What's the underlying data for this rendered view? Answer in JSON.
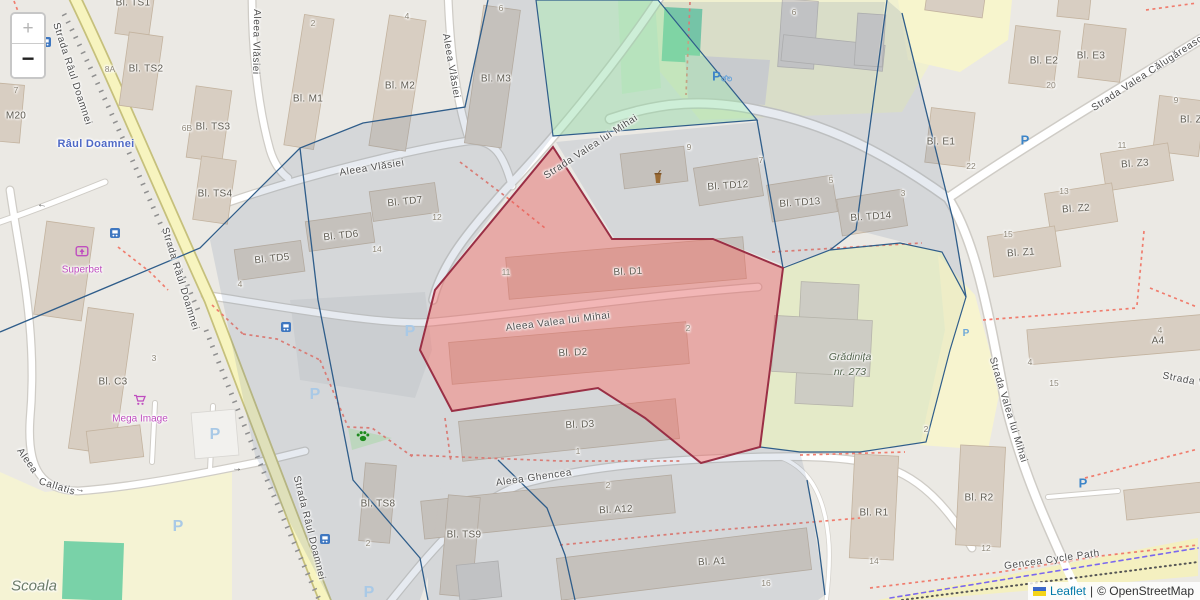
{
  "attribution": {
    "leaflet": "Leaflet",
    "separator": "|",
    "osm": "© OpenStreetMap"
  },
  "controls": {
    "zoom_in": "+",
    "zoom_out": "−"
  },
  "palette": {
    "selected_polygon_fill": "#E05C5C",
    "selected_polygon_stroke": "#9A2F45",
    "district_polygon_stroke": "#2F5D8A",
    "green_polygon_fill": "#8CD7A0",
    "primary_road_yellow": "#F7F4BF",
    "leaflet_link_blue": "#0078A8",
    "poi_magenta": "#BF4EBF",
    "water_label_blue": "#4F69C6"
  },
  "labels": {
    "streets": [
      {
        "t": "Strada Râul Doamnei",
        "x": 72,
        "y": 74,
        "r": 72
      },
      {
        "t": "Strada Râul Doamnei",
        "x": 180,
        "y": 279,
        "r": 73
      },
      {
        "t": "Strada Râul Doamnei",
        "x": 309,
        "y": 528,
        "r": 76
      },
      {
        "t": "Aleea Vlăsiei",
        "x": 256,
        "y": 42,
        "r": 91
      },
      {
        "t": "Aleea Vlăsiei",
        "x": 451,
        "y": 66,
        "r": 80
      },
      {
        "t": "Aleea Vlăsiei",
        "x": 372,
        "y": 168,
        "r": -9
      },
      {
        "t": "Strada Valea lui Mihai",
        "x": 591,
        "y": 147,
        "r": -33
      },
      {
        "t": "Aleea Valea lui Mihai",
        "x": 558,
        "y": 322,
        "r": -7
      },
      {
        "t": "Strada Valea Călugărească",
        "x": 1150,
        "y": 72,
        "r": -33
      },
      {
        "t": "Strada Valea lui Mihai",
        "x": 1008,
        "y": 410,
        "r": 73
      },
      {
        "t": "Strada V",
        "x": 1184,
        "y": 380,
        "r": 11
      },
      {
        "t": "Aleea Ghencea",
        "x": 534,
        "y": 478,
        "r": -8
      },
      {
        "t": "Aleea",
        "x": 27,
        "y": 461,
        "r": 55
      },
      {
        "t": "Callatis",
        "x": 57,
        "y": 487,
        "r": 17
      },
      {
        "t": "Gencea Cycle Path",
        "x": 1052,
        "y": 560,
        "r": -8
      }
    ],
    "buildings": [
      {
        "t": "Bl. TS1",
        "x": 133,
        "y": 3
      },
      {
        "t": "Bl. TS2",
        "x": 146,
        "y": 69
      },
      {
        "t": "Bl. TS3",
        "x": 213,
        "y": 127
      },
      {
        "t": "Bl. TS4",
        "x": 215,
        "y": 194
      },
      {
        "t": "M20",
        "x": 16,
        "y": 116
      },
      {
        "t": "Bl. M1",
        "x": 308,
        "y": 99
      },
      {
        "t": "Bl. M2",
        "x": 400,
        "y": 86
      },
      {
        "t": "Bl. M3",
        "x": 496,
        "y": 79
      },
      {
        "t": "Bl. TD7",
        "x": 405,
        "y": 202,
        "r": -6
      },
      {
        "t": "Bl. TD6",
        "x": 341,
        "y": 236,
        "r": -6
      },
      {
        "t": "Bl. TD5",
        "x": 272,
        "y": 259,
        "r": -6
      },
      {
        "t": "Bl. TD12",
        "x": 728,
        "y": 186,
        "r": -4
      },
      {
        "t": "Bl. TD13",
        "x": 800,
        "y": 203,
        "r": -4
      },
      {
        "t": "Bl. TD14",
        "x": 871,
        "y": 217,
        "r": -4
      },
      {
        "t": "Bl. E1",
        "x": 941,
        "y": 142
      },
      {
        "t": "Bl. E2",
        "x": 1044,
        "y": 61
      },
      {
        "t": "Bl. E3",
        "x": 1091,
        "y": 56
      },
      {
        "t": "Bl. Z4",
        "x": 1194,
        "y": 120
      },
      {
        "t": "Bl. Z3",
        "x": 1135,
        "y": 164,
        "r": -4
      },
      {
        "t": "Bl. Z2",
        "x": 1076,
        "y": 209,
        "r": -4
      },
      {
        "t": "Bl. Z1",
        "x": 1021,
        "y": 253,
        "r": -4
      },
      {
        "t": "A4",
        "x": 1158,
        "y": 341
      },
      {
        "t": "Bl. D1",
        "x": 628,
        "y": 272,
        "r": -3
      },
      {
        "t": "Bl. D2",
        "x": 573,
        "y": 353,
        "r": -3
      },
      {
        "t": "Bl. D3",
        "x": 580,
        "y": 425,
        "r": -3
      },
      {
        "t": "Bl. A12",
        "x": 616,
        "y": 510,
        "r": -3
      },
      {
        "t": "Bl. A1",
        "x": 712,
        "y": 562,
        "r": -3
      },
      {
        "t": "Bl. R1",
        "x": 874,
        "y": 513
      },
      {
        "t": "Bl. R2",
        "x": 979,
        "y": 498
      },
      {
        "t": "Bl. TS8",
        "x": 378,
        "y": 504
      },
      {
        "t": "Bl. TS9",
        "x": 464,
        "y": 535
      },
      {
        "t": "Bl. C3",
        "x": 113,
        "y": 382
      }
    ],
    "numbers": [
      {
        "t": "8A",
        "x": 110,
        "y": 69
      },
      {
        "t": "6B",
        "x": 187,
        "y": 128
      },
      {
        "t": "7",
        "x": 16,
        "y": 90
      },
      {
        "t": "2",
        "x": 313,
        "y": 23
      },
      {
        "t": "4",
        "x": 407,
        "y": 16
      },
      {
        "t": "6",
        "x": 501,
        "y": 8
      },
      {
        "t": "6",
        "x": 794,
        "y": 12
      },
      {
        "t": "9",
        "x": 689,
        "y": 147
      },
      {
        "t": "7",
        "x": 761,
        "y": 160
      },
      {
        "t": "5",
        "x": 831,
        "y": 180
      },
      {
        "t": "3",
        "x": 903,
        "y": 193
      },
      {
        "t": "12",
        "x": 437,
        "y": 217
      },
      {
        "t": "14",
        "x": 377,
        "y": 249
      },
      {
        "t": "4",
        "x": 240,
        "y": 284
      },
      {
        "t": "11",
        "x": 506,
        "y": 272
      },
      {
        "t": "2",
        "x": 688,
        "y": 328
      },
      {
        "t": "1",
        "x": 578,
        "y": 451
      },
      {
        "t": "2",
        "x": 608,
        "y": 485
      },
      {
        "t": "16",
        "x": 766,
        "y": 583
      },
      {
        "t": "14",
        "x": 874,
        "y": 561
      },
      {
        "t": "12",
        "x": 986,
        "y": 548
      },
      {
        "t": "2",
        "x": 368,
        "y": 543
      },
      {
        "t": "3",
        "x": 154,
        "y": 358
      },
      {
        "t": "20",
        "x": 1051,
        "y": 85
      },
      {
        "t": "22",
        "x": 971,
        "y": 166
      },
      {
        "t": "11",
        "x": 1122,
        "y": 145
      },
      {
        "t": "13",
        "x": 1064,
        "y": 191
      },
      {
        "t": "15",
        "x": 1008,
        "y": 234
      },
      {
        "t": "9",
        "x": 1176,
        "y": 100
      },
      {
        "t": "4",
        "x": 1160,
        "y": 330
      },
      {
        "t": "4",
        "x": 1030,
        "y": 362
      },
      {
        "t": "15",
        "x": 1054,
        "y": 383
      },
      {
        "t": "2",
        "x": 926,
        "y": 429
      }
    ],
    "pois": [
      {
        "t": "Superbet",
        "x": 82,
        "y": 270
      },
      {
        "t": "Mega Image",
        "x": 140,
        "y": 419
      }
    ],
    "places": [
      {
        "t": "Grădinița",
        "x": 850,
        "y": 357
      },
      {
        "t": "nr. 273",
        "x": 850,
        "y": 372
      },
      {
        "t": "Scoala",
        "x": 34,
        "y": 586,
        "big": true
      }
    ],
    "water": [
      {
        "t": "Râul Doamnei",
        "x": 96,
        "y": 144
      }
    ]
  },
  "icons": [
    {
      "type": "parking",
      "variant": "bike",
      "x": 722,
      "y": 76
    },
    {
      "type": "parking",
      "x": 1025,
      "y": 140
    },
    {
      "type": "parking",
      "variant": "light",
      "x": 410,
      "y": 332
    },
    {
      "type": "parking",
      "variant": "light",
      "x": 315,
      "y": 395
    },
    {
      "type": "parking",
      "variant": "light",
      "x": 215,
      "y": 435
    },
    {
      "type": "parking",
      "variant": "light",
      "x": 178,
      "y": 527
    },
    {
      "type": "parking",
      "variant": "small",
      "x": 966,
      "y": 334
    },
    {
      "type": "parking",
      "x": 1083,
      "y": 483
    },
    {
      "type": "parking",
      "variant": "light",
      "x": 369,
      "y": 593
    },
    {
      "type": "bus-stop",
      "x": 115,
      "y": 233
    },
    {
      "type": "bus-stop",
      "x": 325,
      "y": 539
    },
    {
      "type": "bus-stop",
      "x": 286,
      "y": 327
    },
    {
      "type": "bus-stop",
      "x": 46,
      "y": 42
    },
    {
      "type": "dog-park",
      "x": 363,
      "y": 436
    },
    {
      "type": "fast-food",
      "x": 658,
      "y": 177
    },
    {
      "type": "betting-shop",
      "x": 82,
      "y": 252
    },
    {
      "type": "supermarket-cart",
      "x": 140,
      "y": 400
    },
    {
      "type": "oneway-arrow",
      "x": 80,
      "y": 490,
      "r": 14
    },
    {
      "type": "oneway-arrow",
      "x": 237,
      "y": 469,
      "r": 5
    },
    {
      "type": "oneway-arrow",
      "x": 42,
      "y": 206,
      "r": 190
    }
  ]
}
